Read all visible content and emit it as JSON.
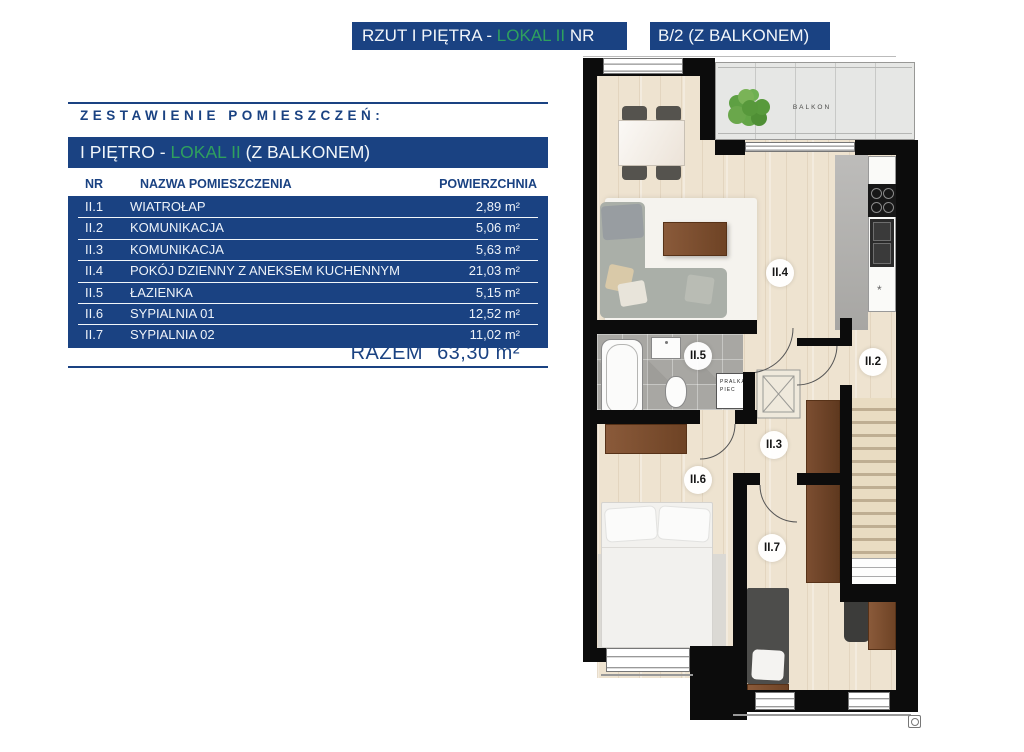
{
  "header": {
    "bar1": {
      "part1": "RZUT I PIĘTRA - ",
      "lokal": "LOKAL II",
      "part2": " NR"
    },
    "bar2": {
      "text": "B/2 (Z BALKONEM)"
    }
  },
  "panel": {
    "heading": "ZESTAWIENIE POMIESZCZEŃ:",
    "subheader": {
      "part1": "I PIĘTRO - ",
      "lokal": "LOKAL II",
      "part2": " (Z BALKONEM)"
    },
    "columns": {
      "nr": "NR",
      "name": "NAZWA POMIESZCZENIA",
      "area": "POWIERZCHNIA"
    },
    "rows": [
      {
        "nr": "II.1",
        "name": "WIATROŁAP",
        "area": "2,89 m²"
      },
      {
        "nr": "II.2",
        "name": "KOMUNIKACJA",
        "area": "5,06 m²"
      },
      {
        "nr": "II.3",
        "name": "KOMUNIKACJA",
        "area": "5,63 m²"
      },
      {
        "nr": "II.4",
        "name": "POKÓJ DZIENNY Z ANEKSEM KUCHENNYM",
        "area": "21,03 m²"
      },
      {
        "nr": "II.5",
        "name": "ŁAZIENKA",
        "area": "5,15 m²"
      },
      {
        "nr": "II.6",
        "name": "SYPIALNIA 01",
        "area": "12,52 m²"
      },
      {
        "nr": "II.7",
        "name": "SYPIALNIA 02",
        "area": "11,02 m²"
      }
    ],
    "total_label": "RAZEM",
    "total_value": "63,30 m²"
  },
  "plan": {
    "balcony_label": "BALKON",
    "pralka_line1": "PRALKA",
    "pralka_line2": "PIEC",
    "labels": {
      "r2": "II.2",
      "r3": "II.3",
      "r4": "II.4",
      "r5": "II.5",
      "r6": "II.6",
      "r7": "II.7"
    }
  },
  "colors": {
    "navy": "#1a4282",
    "green": "#2fa05e"
  }
}
